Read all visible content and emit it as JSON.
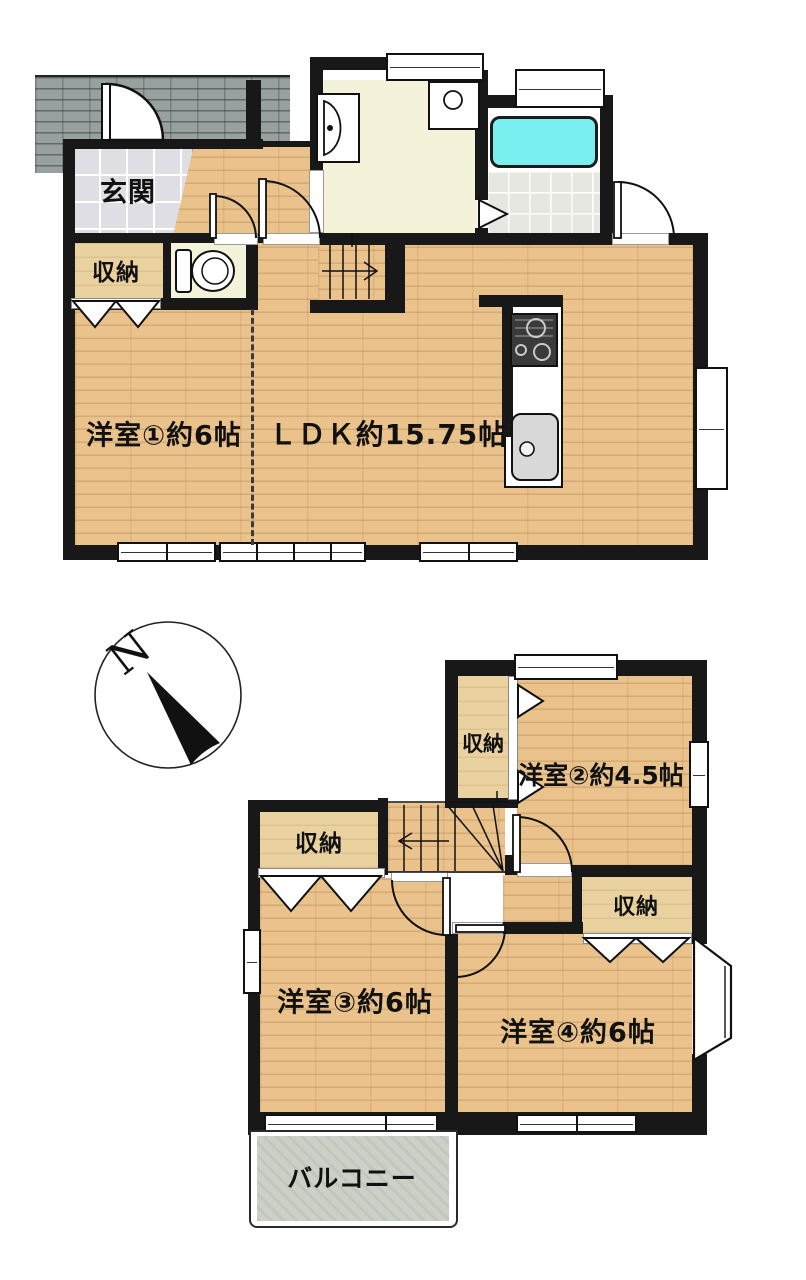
{
  "floor1": {
    "entrance_label": "玄関",
    "storage_label": "収納",
    "room1_label": "洋室①約6帖",
    "ldk_label": "ＬＤＫ約15.75帖"
  },
  "floor2": {
    "storage_north_label": "収納",
    "storage_west_label": "収納",
    "storage_east_label": "収納",
    "room2_label": "洋室②約4.5帖",
    "room3_label": "洋室③約6帖",
    "room4_label": "洋室④約6帖",
    "balcony_label": "バルコニー"
  },
  "compass": {
    "north_label": "N"
  },
  "colors": {
    "wall": "#181818",
    "wood": "#eac28c",
    "wood_light": "#e9d2a0",
    "tile": "#dedee4",
    "paving": "#98a0a0",
    "cream": "#f5f2da",
    "bath_tile": "#e7e7e2",
    "tub": "#79eff0",
    "balcony_floor": "#ccd1c8"
  }
}
